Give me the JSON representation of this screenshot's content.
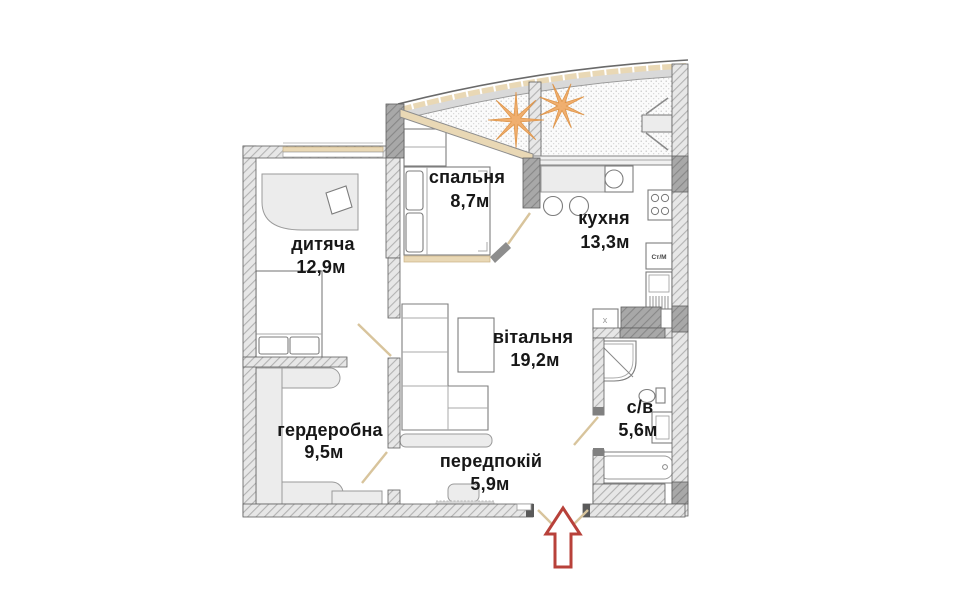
{
  "floor_plan": {
    "rooms": {
      "bedroom": {
        "name": "спальня",
        "area": "8,7м"
      },
      "kitchen": {
        "name": "кухня",
        "area": "13,3м"
      },
      "children": {
        "name": "дитяча",
        "area": "12,9м"
      },
      "living": {
        "name": "вітальня",
        "area": "19,2м"
      },
      "wardrobe": {
        "name": "гердеробна",
        "area": "9,5м"
      },
      "hallway": {
        "name": "передпокій",
        "area": "5,9м"
      },
      "bathroom": {
        "name": "с/в",
        "area": "5,6м"
      }
    },
    "labels": {
      "washing_machine": "Ст/М",
      "vent": "x"
    },
    "entrance": {
      "indicator": "red arrow pointing up at entrance door"
    },
    "colors": {
      "wall_hatch": "#b0b0b0",
      "window_frame": "#e9d8b5",
      "arrow_red": "#b8413a",
      "plant_orange": "#f0a964"
    }
  }
}
